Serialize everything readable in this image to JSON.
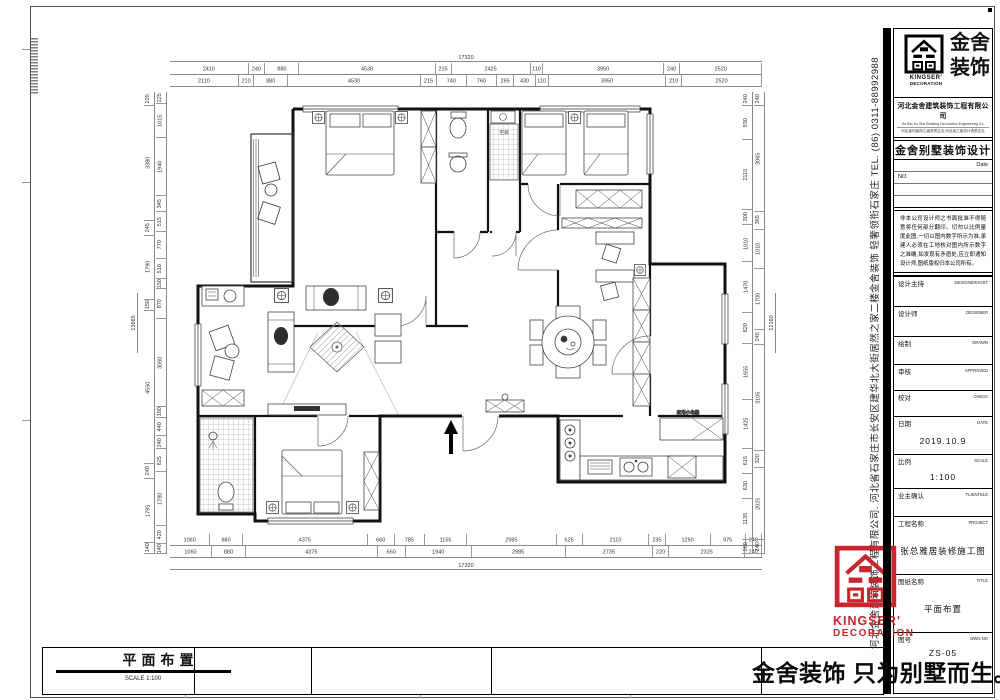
{
  "sheet": {
    "footer_title": "平面布置",
    "footer_scale": "SCALE 1:100",
    "slogan": "金舍装饰 只为别墅而生。"
  },
  "brand": {
    "logo_text_line1": "金舍",
    "logo_text_line2": "装饰",
    "logo_en_line1": "KINGSER'",
    "logo_en_line2": "DECORATION",
    "company": "河北金舍建筑装饰工程有限公司",
    "company_en": "He Bei Jin She Building Decoration Engineering Co.",
    "company_sub": "河北省内装饰乙级资质企业,河北省乙级设计资质企业",
    "brand_product": "金舍别墅装饰设计",
    "side_text": "河北金舍建筑装饰工程有限公司. 河北省石家庄市长安区建华北大街居然之家二楼金舍装饰 轻奢领衔石家庄 TEL. (86) 0311-88992988",
    "accent_red": "#c9252c"
  },
  "titleblock": {
    "date_label": "Date",
    "no_label": "NO.",
    "disclaimer": "非本公司设计师之书面批准不得随意将任何部分翻印。切勿以比例量度此图,一切以图内数字所示为准,承建人必须在工地核对图内所示数字之准确,如发现有矛盾处,应立即通知设计师,图纸版权归本公司所有。",
    "rows": [
      {
        "cn": "设计主持",
        "en": "DESIGNERHOST",
        "value": ""
      },
      {
        "cn": "设计师",
        "en": "DESIGNER",
        "value": ""
      },
      {
        "cn": "绘制",
        "en": "DRAWN",
        "value": ""
      },
      {
        "cn": "审核",
        "en": "APPROVED",
        "value": ""
      },
      {
        "cn": "校对",
        "en": "CHECK",
        "value": ""
      },
      {
        "cn": "日期",
        "en": "DATE",
        "value": "2019.10.9"
      },
      {
        "cn": "比例",
        "en": "SCALE",
        "value": "1:100"
      },
      {
        "cn": "业主确认",
        "en": "TLIENTELE",
        "value": ""
      },
      {
        "cn": "工程名称",
        "en": "PROJECT",
        "value": "张总雅居装修施工图"
      },
      {
        "cn": "图纸名称",
        "en": "TITLE",
        "value": "平面布置"
      },
      {
        "cn": "图号",
        "en": "DWG.NO",
        "value": "ZS-05"
      }
    ]
  },
  "plan": {
    "labels": {
      "appliance": "家用小电器",
      "ac": "空调"
    },
    "dims": {
      "overall_top": "17320",
      "overall_bottom": "17320",
      "overall_left": "13665",
      "overall_right": "12160",
      "top_row1": [
        2410,
        240,
        880,
        4530,
        215,
        2425,
        110,
        3950,
        240,
        2520
      ],
      "top_row2": [
        2110,
        210,
        880,
        4530,
        215,
        740,
        760,
        265,
        430,
        110,
        3950,
        210,
        2520
      ],
      "bottom_row1": [
        1060,
        880,
        4375,
        660,
        785,
        1155,
        2985,
        625,
        2110,
        235,
        1250,
        975,
        240
      ],
      "bottom_row2": [
        1060,
        880,
        4375,
        660,
        1940,
        2985,
        2735,
        220,
        2325,
        240
      ],
      "left_row1": [
        225,
        3380,
        245,
        1790,
        150,
        4550,
        240,
        1795,
        140
      ],
      "left_row2": [
        225,
        1015,
        1940,
        345,
        515,
        770,
        510,
        150,
        870,
        3060,
        180,
        440,
        240,
        625,
        1780,
        420,
        140
      ],
      "right_row1": [
        240,
        930,
        2115,
        300,
        1010,
        1470,
        820,
        1655,
        1425,
        615,
        630,
        1135,
        260
      ],
      "right_row2": [
        240,
        3065,
        365,
        1010,
        1700,
        245,
        3105,
        320,
        2025,
        240
      ]
    }
  }
}
